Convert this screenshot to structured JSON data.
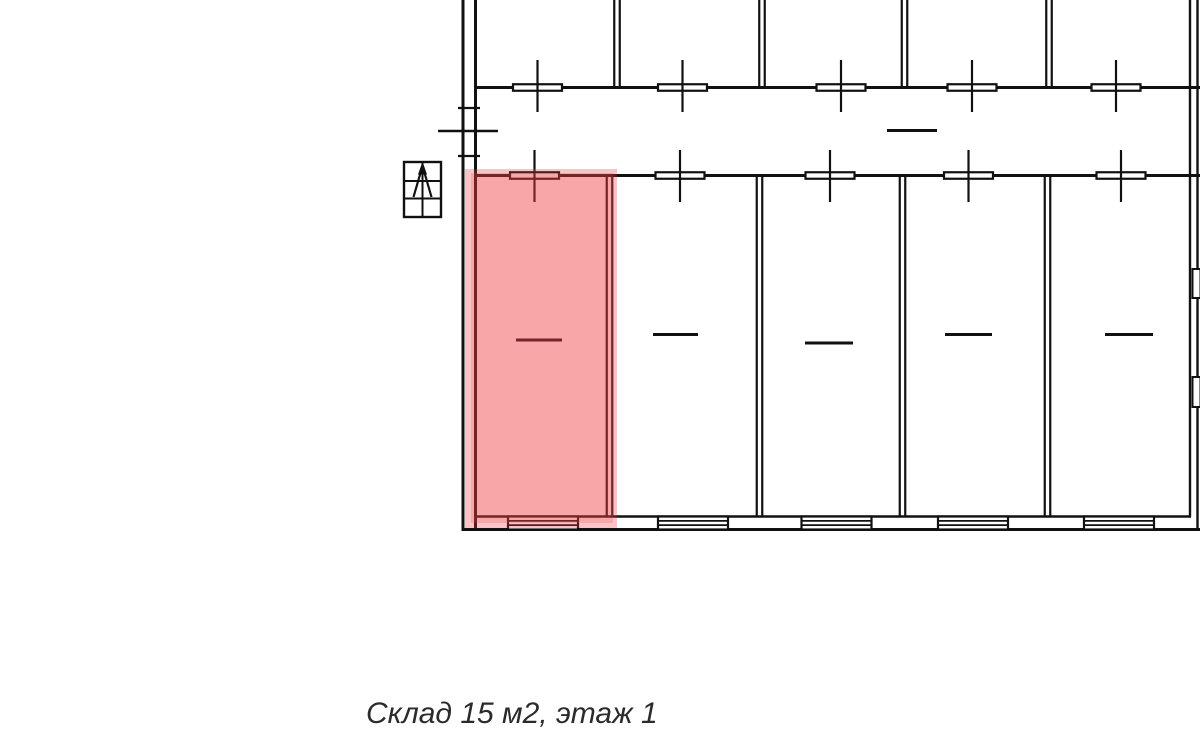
{
  "caption": {
    "text": "Склад 15 м2, этаж 1"
  },
  "colors": {
    "line": "#111111",
    "background": "#ffffff",
    "caption_text": "#2b2b2b",
    "highlight": "#f03c41",
    "highlight_halo_opacity": 0.3,
    "highlight_inner_opacity": 0.45
  },
  "plan": {
    "outer": {
      "left_x": [
        463,
        475.5
      ],
      "right_x": [
        1190,
        1197.5
      ],
      "top_wall_y": 87.5,
      "corridor_wall_y": 175.5,
      "floor_line_y": 516.5,
      "bottom_wall_y": 529.5,
      "right_windows": [
        {
          "x": 1192.5,
          "y": 269,
          "w": 8,
          "h": 29
        },
        {
          "x": 1192.5,
          "y": 377,
          "w": 8,
          "h": 30
        }
      ]
    },
    "top_row": {
      "separators_x": [
        617,
        762,
        904.5,
        1049
      ],
      "separator_y": [
        0,
        86.5
      ],
      "doors_x": [
        537.5,
        682.5,
        841,
        972,
        1116
      ],
      "door_bar": {
        "w": 49,
        "h": 6.5
      },
      "door_stem_y": [
        60,
        112
      ]
    },
    "corridor": {
      "dash": {
        "x1": 887,
        "x2": 937,
        "y": 130.5
      },
      "entrance": {
        "ticks_y": [
          108,
          156
        ],
        "tick_x": [
          458,
          480
        ],
        "leaf_y": 131,
        "leaf_x": [
          438,
          498
        ]
      }
    },
    "bottom_row": {
      "separators_x": [
        609.5,
        759.5,
        902.5,
        1047.5
      ],
      "separator_y": [
        176,
        516
      ],
      "doors_x": [
        534.5,
        680,
        830,
        968.5,
        1121
      ],
      "door_bar": {
        "w": 49,
        "h": 6.5
      },
      "door_stem_y": [
        150,
        202
      ],
      "dashes": [
        {
          "x1": 516,
          "x2": 562,
          "y": 340
        },
        {
          "x1": 653,
          "x2": 698,
          "y": 334.5
        },
        {
          "x1": 805,
          "x2": 853,
          "y": 343
        },
        {
          "x1": 945,
          "x2": 992,
          "y": 334.5
        },
        {
          "x1": 1105,
          "x2": 1153,
          "y": 334.5
        }
      ],
      "grilles": {
        "centers_x": [
          543,
          693,
          836.5,
          973,
          1119
        ],
        "w": 70,
        "y_top": 516.5,
        "y_bottom": 529.5,
        "lines_y": [
          520.9,
          525.1
        ]
      }
    },
    "stairs_icon": {
      "x": 404,
      "y": 162,
      "w": 37,
      "h": 55,
      "row_lines_y": [
        181,
        198.5
      ],
      "center_x": 422.5
    },
    "highlight": {
      "halo": {
        "x": 465,
        "y": 169,
        "w": 152,
        "h": 359
      },
      "inner": {
        "x": 471,
        "y": 173,
        "w": 142,
        "h": 350
      }
    }
  }
}
